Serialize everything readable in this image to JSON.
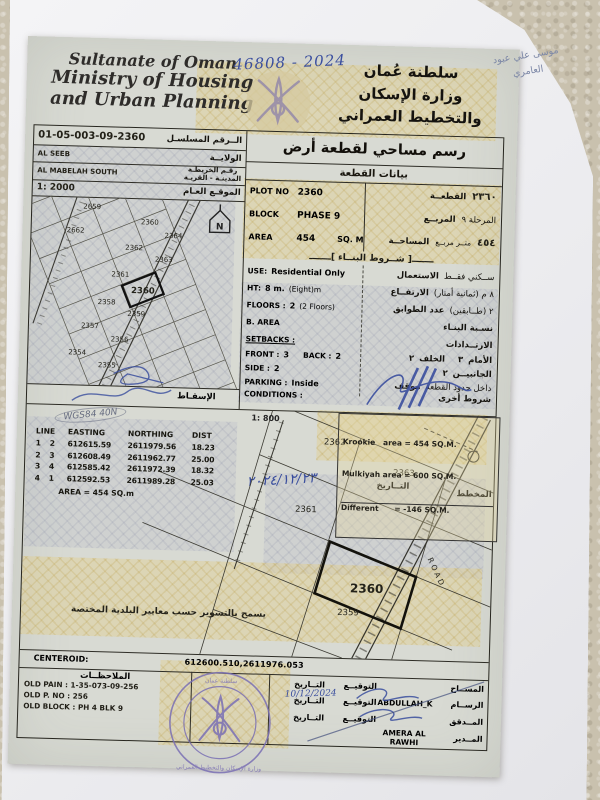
{
  "colors": {
    "ink_blue": "#3a4e9e",
    "stamp_purple": "#7a6fb4",
    "pencil_gray": "#7c87a6",
    "paper": "#d8dad3",
    "pattern_gold": "#cdb97a"
  },
  "photo": {
    "handwritten_case_number": "46808 - 2024",
    "pencil_note_line1": "موسى علي عبود",
    "pencil_note_line2": "العامري"
  },
  "header": {
    "en_line1": "Sultanate of Oman",
    "en_line2": "Ministry of Housing",
    "en_line3": "and Urban Planning",
    "ar_line1": "سلطنة عُمان",
    "ar_line2": "وزارة الإسكان",
    "ar_line3": "والتخطيط العمراني"
  },
  "form": {
    "serial_number": "01-05-003-09-2360",
    "serial_label_ar": "الــرقم المسلسـل",
    "wilayat_value": "AL SEEB",
    "wilayat_label_ar": "الولايــة",
    "town_value": "AL MABELAH SOUTH",
    "map_no_label_ar": "رقـم الخريطـة",
    "town_label_ar": "المدينـة - القريـة",
    "title_ar": "رسم مساحي لقطعة أرض",
    "subtitle_ar": "بيانات القطعة"
  },
  "location_map": {
    "scale": "1: 2000",
    "label_ar": "الموقـع العـام",
    "north_letter": "N",
    "plots": [
      "2659",
      "2662",
      "2360",
      "2364",
      "2362",
      "2363",
      "2361",
      "2360",
      "2358",
      "2359",
      "2357",
      "2356",
      "2354",
      "2355"
    ]
  },
  "plot_data": {
    "plot_no_label": "PLOT NO",
    "plot_no": "2360",
    "plot_no_ar": "٢٣٦٠",
    "plot_label_ar": "القطعــة",
    "block_label": "BLOCK",
    "block": "PHASE 9",
    "block_ar": "المرحلة ٩",
    "block_label_ar": "المربــع",
    "area_label": "AREA",
    "area": "454",
    "area_unit": "SQ. M",
    "area_ar": "٤٥٤",
    "area_unit_ar": "متــر مربــع",
    "area_label_ar": "المساحــة"
  },
  "building": {
    "header_deco": "ـــــــ[ شــروط البنــاء ]ـــــــ",
    "use_label": "USE:",
    "use": "Residential Only",
    "use_ar": "ســكني فقــط",
    "use_label_ar": "الاستعمال",
    "ht_label": "HT:",
    "ht": "8 m.",
    "ht_note": "(Eight)m",
    "ht_ar": "٨ م (ثمانية أمتار)",
    "ht_label_ar": "الارتفــاع",
    "floors_label": "FLOORS :",
    "floors": "2",
    "floors_note": "(2 Floors)",
    "floors_ar": "٢ (طــابقين)",
    "floors_label_ar": "عدد الطوابق",
    "barea_label": "B. AREA",
    "barea_label_ar": "نسـبة البنـاء"
  },
  "setbacks": {
    "header": "SETBACKS :",
    "header_ar": "الارتــدادات",
    "front_label": "FRONT :",
    "front": "3",
    "back_label": "BACK :",
    "back": "2",
    "front_label_ar": "الأمام",
    "front_ar": "٣",
    "back_label_ar": "الخلف",
    "back_ar": "٢",
    "side_label": "SIDE :",
    "side": "2",
    "side_label_ar": "الجانبيــن",
    "side_ar": "٢",
    "parking_label": "PARKING :",
    "parking": "Inside",
    "parking_label_ar": "موقف",
    "parking_ar": "داخل حدود القطعة",
    "conditions_label": "CONDITIONS :",
    "conditions_label_ar": "شروط أخرى",
    "date_label_ar": "التــاريخ",
    "plan_label_ar": "المخطط"
  },
  "hand": {
    "date_ar": "٢٠٢٤/١٢/٢٣",
    "date_footer": "10/12/2024",
    "wgs": "WGS84 40N"
  },
  "main_map": {
    "scale": "1: 800",
    "projection_label_ar": "الإسقـاط",
    "krookie_line1": "Krookie   area = 454 SQ.M.",
    "krookie_line2": "Mulkiyah area = 600 SQ.M.",
    "krookie_line3": "Different      = -146 SQ.M.",
    "road_label": "ROAD",
    "plots": [
      "2362",
      "2363",
      "2361",
      "2360",
      "2359"
    ],
    "fence_note_ar": "يسمح بالتسوير حسب معايير البلدية المختصة"
  },
  "coords": {
    "headers": [
      "LINE",
      "EASTING",
      "NORTHING",
      "DIST"
    ],
    "rows": [
      [
        "1",
        "2",
        "612615.59",
        "2611979.56",
        "18.23"
      ],
      [
        "2",
        "3",
        "612608.49",
        "2611962.77",
        "25.00"
      ],
      [
        "3",
        "4",
        "612585.42",
        "2611972.39",
        "18.32"
      ],
      [
        "4",
        "1",
        "612592.53",
        "2611989.28",
        "25.03"
      ]
    ],
    "area_line": "AREA = 454  SQ.m"
  },
  "footer": {
    "centeroid_label": "CENTEROID:",
    "centeroid_value": "612600.510,2611976.053",
    "notes_title_ar": "الملاحظــات",
    "note1": "OLD PAIN : 1-35-073-09-256",
    "note2": "OLD P. NO : 256",
    "note3": "OLD BLOCK : PH 4 BLK 9",
    "sig": {
      "col_sign_ar": "التوقيــع",
      "col_date_ar": "التــاريخ",
      "rows": [
        {
          "role": "المســاح",
          "name": ""
        },
        {
          "role": "الرســام",
          "name": "ABDULLAH_K"
        },
        {
          "role": "المــدقق",
          "name": ""
        },
        {
          "role": "المــدير",
          "name": "AMERA AL RAWHI"
        }
      ]
    }
  }
}
